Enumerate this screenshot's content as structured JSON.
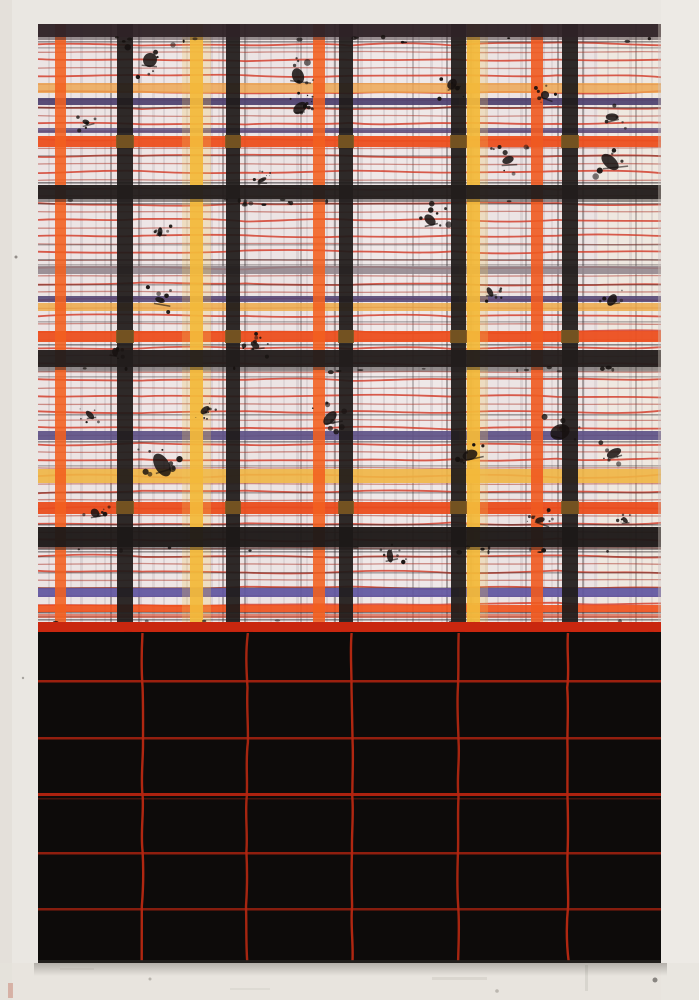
{
  "scene": {
    "w": 699,
    "h": 1000
  },
  "wall": {
    "base": "#eae7e2",
    "left_shade": "#e2ded8",
    "right_shade": "#edebe6",
    "bottom_shade": "#e6e2dc",
    "specks": [
      {
        "x": 16,
        "y": 257,
        "r": 1.5,
        "c": "#4a4440",
        "o": 0.55
      },
      {
        "x": 23,
        "y": 678,
        "r": 1.2,
        "c": "#55504b",
        "o": 0.45
      },
      {
        "x": 655,
        "y": 980,
        "r": 2.5,
        "c": "#4a4642",
        "o": 0.6
      },
      {
        "x": 150,
        "y": 979,
        "r": 1.5,
        "c": "#8a857e",
        "o": 0.5
      },
      {
        "x": 497,
        "y": 991,
        "r": 1.8,
        "c": "#908a82",
        "o": 0.5
      },
      {
        "x": 70,
        "y": 940,
        "r": 1.2,
        "c": "#9a948c",
        "o": 0.4
      }
    ],
    "streaks": [
      {
        "x": 8,
        "y": 983,
        "w": 5,
        "h": 15,
        "c": "#c06a55",
        "o": 0.4
      },
      {
        "x": 432,
        "y": 977,
        "w": 55,
        "h": 3,
        "c": "#d6d2cb",
        "o": 0.8
      },
      {
        "x": 230,
        "y": 988,
        "w": 40,
        "h": 2,
        "c": "#d9d5ce",
        "o": 0.7
      },
      {
        "x": 585,
        "y": 965,
        "w": 3,
        "h": 26,
        "c": "#d2cec7",
        "o": 0.7
      },
      {
        "x": 60,
        "y": 968,
        "w": 34,
        "h": 2,
        "c": "#d8d4cd",
        "o": 0.6
      }
    ]
  },
  "painting": {
    "x": 38,
    "y": 24,
    "w": 623,
    "h": 939,
    "split_y": 622,
    "edge_c": "#cfc6bb"
  },
  "plaid": {
    "bg": "#ece4e4",
    "washes": [
      {
        "x": 598,
        "w": 60,
        "c": "#f2ecdc",
        "o": 0.5
      },
      {
        "x": 352,
        "w": 96,
        "c": "#f4eeee",
        "o": 0.4
      },
      {
        "x": 133,
        "w": 90,
        "c": "#f3ecec",
        "o": 0.32
      }
    ],
    "pin_v_color": "#9b8f96",
    "pin_v": [
      [
        48,
        2,
        0.2
      ],
      [
        70,
        2,
        0.14
      ],
      [
        80,
        3,
        0.22
      ],
      [
        95,
        2,
        0.16
      ],
      [
        104,
        2,
        0.2
      ],
      [
        140,
        2,
        0.25
      ],
      [
        152,
        3,
        0.18
      ],
      [
        163,
        2,
        0.22
      ],
      [
        176,
        2,
        0.16
      ],
      [
        186,
        2,
        0.2
      ],
      [
        210,
        3,
        0.22
      ],
      [
        218,
        2,
        0.18
      ],
      [
        246,
        2,
        0.22
      ],
      [
        258,
        3,
        0.16
      ],
      [
        270,
        2,
        0.2
      ],
      [
        283,
        2,
        0.16
      ],
      [
        296,
        3,
        0.22
      ],
      [
        306,
        2,
        0.18
      ],
      [
        326,
        2,
        0.22
      ],
      [
        333,
        2,
        0.16
      ],
      [
        360,
        3,
        0.2
      ],
      [
        370,
        2,
        0.16
      ],
      [
        383,
        2,
        0.22
      ],
      [
        394,
        3,
        0.16
      ],
      [
        406,
        2,
        0.2
      ],
      [
        418,
        2,
        0.16
      ],
      [
        430,
        3,
        0.22
      ],
      [
        441,
        2,
        0.18
      ],
      [
        472,
        2,
        0.2
      ],
      [
        485,
        3,
        0.16
      ],
      [
        497,
        2,
        0.22
      ],
      [
        508,
        2,
        0.16
      ],
      [
        520,
        3,
        0.2
      ],
      [
        543,
        2,
        0.22
      ],
      [
        551,
        2,
        0.16
      ],
      [
        583,
        2,
        0.2
      ],
      [
        594,
        3,
        0.16
      ],
      [
        607,
        2,
        0.22
      ],
      [
        617,
        2,
        0.16
      ],
      [
        629,
        3,
        0.2
      ],
      [
        641,
        2,
        0.16
      ],
      [
        651,
        2,
        0.2
      ]
    ],
    "pin_v_dark_color": "#3a3335",
    "pin_v_dark": [
      [
        110,
        2,
        0.4
      ],
      [
        138,
        2,
        0.38
      ],
      [
        222,
        2,
        0.4
      ],
      [
        244,
        2,
        0.38
      ],
      [
        334,
        2,
        0.4
      ],
      [
        357,
        2,
        0.38
      ],
      [
        446,
        2,
        0.4
      ],
      [
        470,
        2,
        0.35
      ],
      [
        557,
        2,
        0.4
      ],
      [
        582,
        2,
        0.38
      ],
      [
        300,
        2,
        0.28
      ],
      [
        412,
        2,
        0.28
      ],
      [
        525,
        2,
        0.28
      ],
      [
        635,
        2,
        0.3
      ]
    ],
    "red_lines": {
      "y0": 44,
      "y1": 618,
      "step": 8,
      "bright": "#d23b28",
      "dim": "#a93226"
    },
    "pin_h_color": "#2e282b",
    "pin_h": [
      [
        41,
        0.45
      ],
      [
        47,
        0.3
      ],
      [
        107,
        0.5
      ],
      [
        130,
        0.35
      ],
      [
        155,
        0.3
      ],
      [
        182,
        0.55
      ],
      [
        203,
        0.45
      ],
      [
        244,
        0.3
      ],
      [
        259,
        0.4
      ],
      [
        264,
        0.3
      ],
      [
        284,
        0.35
      ],
      [
        321,
        0.3
      ],
      [
        344,
        0.5
      ],
      [
        370,
        0.45
      ],
      [
        376,
        0.3
      ],
      [
        414,
        0.4
      ],
      [
        441,
        0.45
      ],
      [
        465,
        0.3
      ],
      [
        492,
        0.35
      ],
      [
        524,
        0.5
      ],
      [
        551,
        0.45
      ],
      [
        556,
        0.3
      ],
      [
        572,
        0.35
      ],
      [
        587,
        0.3
      ],
      [
        612,
        0.45
      ],
      [
        616,
        0.4
      ],
      [
        619,
        0.5
      ]
    ],
    "bands": [
      [
        83,
        10,
        "#eda44c",
        0.8
      ],
      [
        98,
        7,
        "#4c3f6e",
        0.92
      ],
      [
        128,
        5,
        "#5a4a7c",
        0.8
      ],
      [
        136,
        11,
        "#ec4f1f",
        0.95
      ],
      [
        266,
        8,
        "#8e8289",
        0.85
      ],
      [
        296,
        6,
        "#554877",
        0.9
      ],
      [
        303,
        8,
        "#eea843",
        0.82
      ],
      [
        331,
        11,
        "#ec4f1f",
        0.95
      ],
      [
        431,
        9,
        "#5d5187",
        0.92
      ],
      [
        469,
        14,
        "#f0b544",
        0.9
      ],
      [
        502,
        12,
        "#ea4d1e",
        0.95
      ],
      [
        588,
        9,
        "#5f55a0",
        0.92
      ],
      [
        605,
        7,
        "#f04f1a",
        0.9
      ],
      [
        614,
        4,
        "#d94327",
        0.6
      ]
    ],
    "stripes": [
      [
        55,
        11,
        "#f2601f",
        0.88,
        0
      ],
      [
        190,
        13,
        "#f3b93a",
        0.92,
        1
      ],
      [
        313,
        12,
        "#f2601f",
        0.88,
        0
      ],
      [
        467,
        13,
        "#f3b93a",
        0.92,
        1
      ],
      [
        531,
        12,
        "#ef5a20",
        0.9,
        0
      ]
    ],
    "halo_c": "#f0c557",
    "black_v_c": "#1f1b1a",
    "black_v": [
      [
        117,
        16
      ],
      [
        226,
        14
      ],
      [
        339,
        14
      ],
      [
        451,
        15
      ],
      [
        562,
        16
      ]
    ],
    "black_h": [
      [
        24,
        13,
        "#2f2226"
      ],
      [
        185,
        14,
        "#221d1c"
      ],
      [
        350,
        17,
        "#221d1c"
      ],
      [
        527,
        20,
        "#1d1918"
      ]
    ],
    "brown_bands": [
      136,
      331,
      502
    ],
    "brown_c": "#7d5a22",
    "splat_c": "#16110f",
    "splatters": [
      [
        150,
        60,
        1.3
      ],
      [
        298,
        76,
        1.2
      ],
      [
        452,
        84,
        1.0
      ],
      [
        545,
        95,
        0.7
      ],
      [
        612,
        117,
        0.8
      ],
      [
        86,
        122,
        0.7
      ],
      [
        300,
        108,
        0.9
      ],
      [
        508,
        160,
        1.1
      ],
      [
        610,
        162,
        1.3
      ],
      [
        160,
        232,
        0.6
      ],
      [
        430,
        220,
        1.1
      ],
      [
        262,
        180,
        0.6
      ],
      [
        160,
        300,
        0.9
      ],
      [
        490,
        292,
        0.7
      ],
      [
        612,
        300,
        0.8
      ],
      [
        115,
        352,
        0.8
      ],
      [
        330,
        418,
        1.1
      ],
      [
        560,
        432,
        1.3
      ],
      [
        162,
        465,
        1.4
      ],
      [
        614,
        453,
        0.9
      ],
      [
        95,
        513,
        0.8
      ],
      [
        390,
        556,
        0.9
      ],
      [
        540,
        520,
        0.7
      ],
      [
        255,
        345,
        0.8
      ],
      [
        470,
        455,
        0.9
      ],
      [
        205,
        410,
        0.6
      ],
      [
        90,
        415,
        0.6
      ],
      [
        625,
        520,
        0.6
      ]
    ],
    "edge_speck_rows": [
      37,
      199,
      367,
      547,
      620
    ]
  },
  "boundary": {
    "band_y": 622,
    "band_h": 10,
    "band_c": "#c9270f",
    "line2_y": 641,
    "line2_c": "#c22a12",
    "stub_c": "#181312",
    "drip_c": "#c3250f",
    "drips": [
      [
        124,
        8,
        20
      ],
      [
        230,
        16,
        26
      ],
      [
        248,
        5,
        14
      ],
      [
        341,
        9,
        40
      ],
      [
        350,
        5,
        60
      ],
      [
        453,
        12,
        38
      ],
      [
        560,
        8,
        25
      ],
      [
        567,
        4,
        14
      ],
      [
        648,
        6,
        10
      ]
    ],
    "wavy_drips": [
      [
        233,
        760
      ],
      [
        344,
        790
      ],
      [
        457,
        770
      ]
    ]
  },
  "black_sec": {
    "bg": "#0d0b0a",
    "v_c": "#c22a12",
    "v_lines": [
      [
        142,
        0.9
      ],
      [
        247,
        0.85
      ],
      [
        352,
        0.9
      ],
      [
        458,
        0.85
      ],
      [
        568,
        0.9
      ]
    ],
    "h_c": "#b52410",
    "h_lines": [
      [
        680,
        0.85,
        2.5
      ],
      [
        737,
        0.8,
        2.5
      ],
      [
        793,
        0.95,
        3
      ],
      [
        798,
        0.35,
        1.5
      ],
      [
        852,
        0.78,
        2.5
      ],
      [
        908,
        0.72,
        2.5
      ]
    ],
    "bottom_edge_c": "#262220"
  },
  "shadow": {
    "c": "#37322d",
    "o": 0.3
  }
}
